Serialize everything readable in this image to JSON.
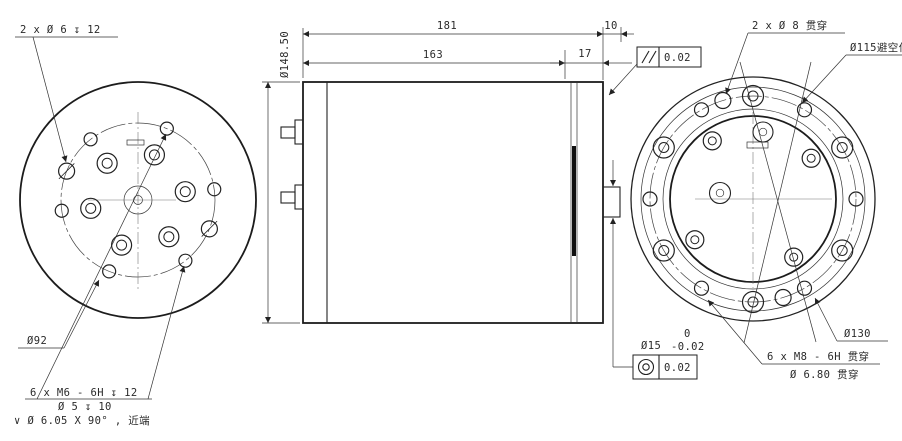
{
  "colors": {
    "line": "#222222",
    "background": "#ffffff"
  },
  "left_view": {
    "annotations": {
      "dowel_note": "2 x Ø 6 ↧ 12",
      "bolt_circle_dia": "Ø92",
      "tap_note_line1": "6 x M6 - 6H ↧ 12",
      "tap_note_line2": "Ø 5 ↧ 10",
      "tap_note_line3": "∨ Ø 6.05 X 90° , 近端"
    }
  },
  "side_view": {
    "dims": {
      "overall_length": "181",
      "body_length": "163",
      "flange_width": "17",
      "shaft_protrusion": "10",
      "outer_diameter": "Ø148.50"
    },
    "parallelism": {
      "icon": "parallelism-icon",
      "value": "0.02"
    },
    "shaft": {
      "dia": "Ø15",
      "tol_upper": "0",
      "tol_lower": "-0.02",
      "concentricity_icon": "concentricity-icon",
      "concentricity_value": "0.02"
    }
  },
  "right_view": {
    "annotations": {
      "through_holes_note": "2 x Ø 8 贯穿",
      "clearance_note": "Ø115避空位",
      "bolt_circle_dia": "Ø130",
      "tap_note_line1": "6 x M8 - 6H 贯穿",
      "tap_note_line2": "Ø 6.80 贯穿"
    }
  },
  "geometry": {
    "hole_patterns": [
      {
        "name": "m6-tapped-hole",
        "cx": 138,
        "cy": 200,
        "rpos": 77,
        "r": 6.5,
        "angles": [
          -8,
          -68,
          -128,
          52,
          112,
          172
        ]
      },
      {
        "name": "dowel-hole",
        "cx": 138,
        "cy": 200,
        "rpos": 77,
        "r": 8,
        "hatched": true,
        "angles": [
          -158,
          22
        ]
      },
      {
        "name": "counterbored-hole",
        "cx": 138,
        "cy": 200,
        "rpos": 48,
        "r": 10,
        "r_in": 5,
        "angles": [
          -10,
          -70,
          -130,
          50,
          110,
          170
        ]
      },
      {
        "name": "m8-counterbored-hole",
        "cx": 753,
        "cy": 199,
        "rpos": 103,
        "r": 10.5,
        "r_in": 5,
        "angles": [
          -90,
          -30,
          30,
          90,
          150,
          210
        ]
      },
      {
        "name": "through-hole-6-8",
        "cx": 753,
        "cy": 199,
        "rpos": 103,
        "r": 7,
        "angles": [
          -120,
          -60,
          0,
          60,
          120,
          180
        ]
      },
      {
        "name": "through-hole-8",
        "cx": 753,
        "cy": 199,
        "rpos": 103,
        "r": 8,
        "angles": [
          -107,
          73
        ]
      },
      {
        "name": "inner-counterbored-hole",
        "cx": 753,
        "cy": 199,
        "rpos": 71,
        "r": 9,
        "r_in": 4,
        "angles": [
          -125,
          -35,
          55,
          145
        ]
      }
    ]
  }
}
